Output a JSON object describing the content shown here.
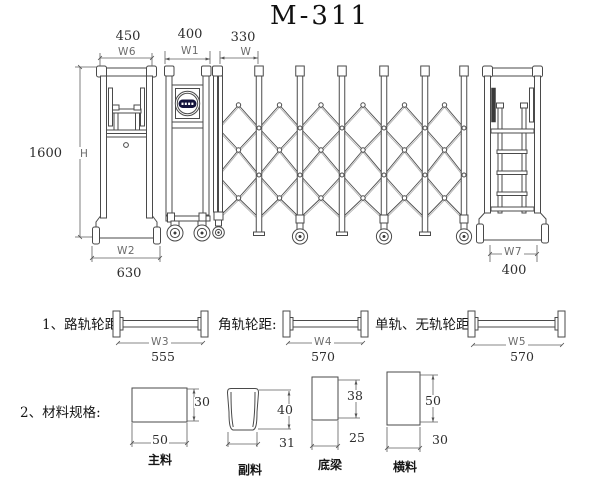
{
  "title": "M-311",
  "colors": {
    "line": "#4a4a4a",
    "line_light": "#b0b0b0",
    "logo_band": "#14143c"
  },
  "dims": {
    "w6": {
      "value": "450",
      "label": "W6"
    },
    "w1": {
      "value": "400",
      "label": "W1"
    },
    "w": {
      "value": "330",
      "label": "W"
    },
    "h": {
      "value": "1600",
      "label": "H"
    },
    "w2": {
      "label": "W2",
      "value": "630"
    },
    "w7": {
      "label": "W7",
      "value": "400"
    }
  },
  "spacing": {
    "item1": {
      "label": "1、路轨轮距:",
      "dim": "W3",
      "value": "555"
    },
    "item2": {
      "label": "角轨轮距:",
      "dim": "W4",
      "value": "570"
    },
    "item3": {
      "label": "单轨、无轨轮距:",
      "dim": "W5",
      "value": "570"
    }
  },
  "materials": {
    "heading": "2、材料规格:",
    "items": [
      {
        "name": "主料",
        "width": "50",
        "height": "30"
      },
      {
        "name": "副料",
        "width": "31",
        "height": "40"
      },
      {
        "name": "底梁",
        "width": "25",
        "height": "38"
      },
      {
        "name": "横料",
        "width": "30",
        "height": "50"
      }
    ]
  }
}
